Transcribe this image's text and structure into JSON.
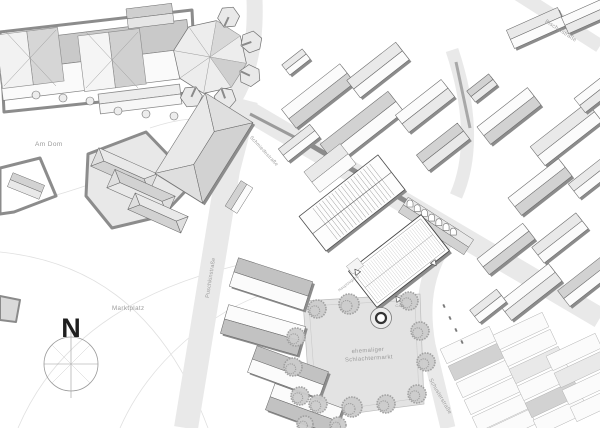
{
  "title": "Lageplan",
  "labels": {
    "north": "N",
    "am_dom": "Am Dom",
    "marktplatz": "Marktplatz",
    "park_line1": "ehemaliger",
    "park_line2": "Schlachtermarkt",
    "street_left": "Puschkinstraße",
    "street_center": "Schmiedestraße",
    "street_top_right": "Bischofstraße",
    "street_bottom_right": "Schusterstraße",
    "entrance_main": "Hauptzugang",
    "cafe": "Café"
  },
  "colors": {
    "paper": "#ffffff",
    "street": "#e9e9e9",
    "park": "#e3e3e3",
    "roof_white": "#fbfbfb",
    "roof_light": "#e9e9e9",
    "roof_mid": "#d2d2d2",
    "roof_dark": "#c2c2c2",
    "roof_end": "#dfdfdf",
    "wall_shadow": "#8c8c8c",
    "outline": "#6b6b6b",
    "tree": "#9e9e9e",
    "tree_fill": "#cccccc",
    "contour": "#e0e0e0",
    "label_gray": "#9a9a9a",
    "north_black": "#1f1f1f"
  }
}
